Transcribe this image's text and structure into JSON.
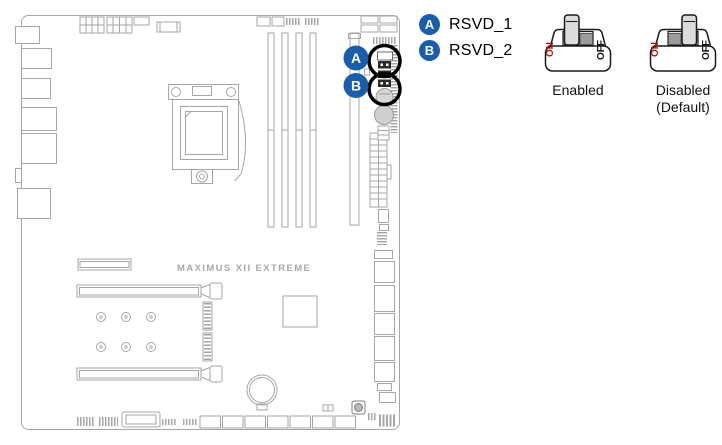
{
  "margin_fragment": "e",
  "board": {
    "brand_label": "MAXIMUS XII EXTREME"
  },
  "legend": {
    "items": [
      {
        "badge": "A",
        "label": "RSVD_1"
      },
      {
        "badge": "B",
        "label": "RSVD_2"
      }
    ]
  },
  "switch_states": [
    {
      "label": "Enabled",
      "sublabel": "",
      "on_label": "ON",
      "off_label": "OFF",
      "lever_position": "on"
    },
    {
      "label": "Disabled",
      "sublabel": "(Default)",
      "on_label": "ON",
      "off_label": "OFF",
      "lever_position": "off"
    }
  ],
  "colors": {
    "callout_blue": "#1a5dab",
    "highlight_ring": "#000000",
    "on_label_red": "#b11212",
    "board_line_gray": "#a6a6a6"
  }
}
